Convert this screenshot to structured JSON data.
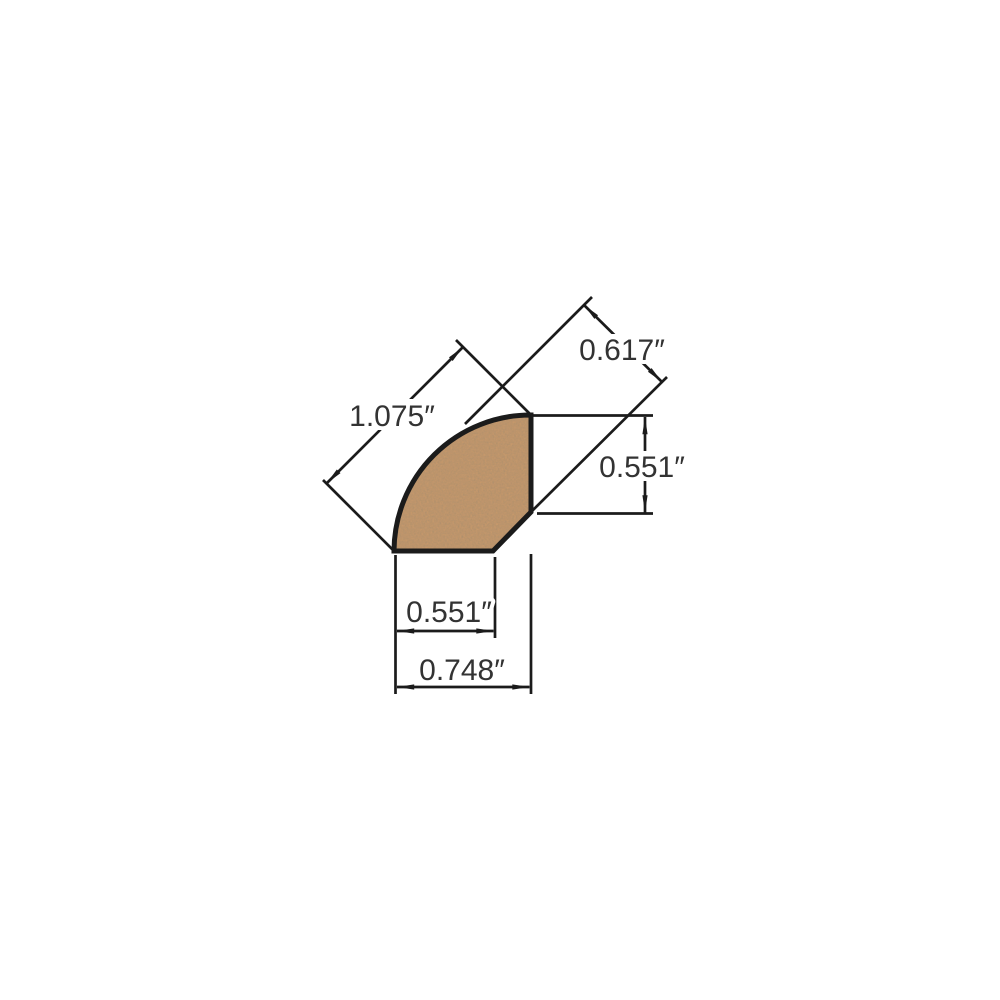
{
  "diagram": {
    "colors": {
      "wood_fill": "#c89a6c",
      "line": "#1b1b1b",
      "text": "#333333",
      "background": "#ffffff"
    },
    "labels": {
      "diagonal_width": "1.075″",
      "diagonal_thickness": "0.617″",
      "side_height": "0.551″",
      "bottom_width": "0.551″",
      "overall_width": "0.748″"
    }
  }
}
